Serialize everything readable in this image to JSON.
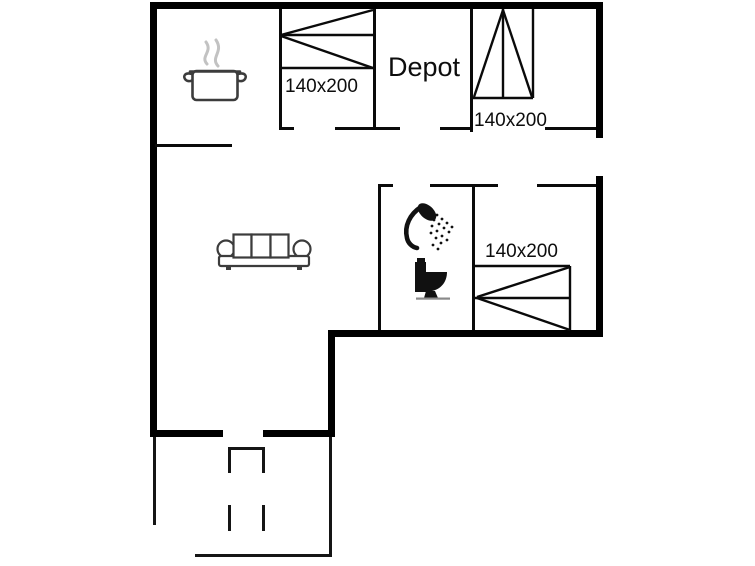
{
  "plan": {
    "type": "floor-plan",
    "background": "#ffffff",
    "wall_color": "#000000",
    "icon_outline_color": "#3c3c3c",
    "fixture_color": "#111111",
    "steam_color": "#c2c2c2",
    "shadow_color": "#8a8a8a",
    "labels": {
      "depot": "Depot",
      "bed_top_left": "140x200",
      "bed_top_right": "140x200",
      "bed_bottom_right": "140x200"
    },
    "icons": [
      "cooking-pot-icon",
      "sofa-icon",
      "shower-icon",
      "toilet-icon",
      "double-bed-symbol"
    ]
  }
}
